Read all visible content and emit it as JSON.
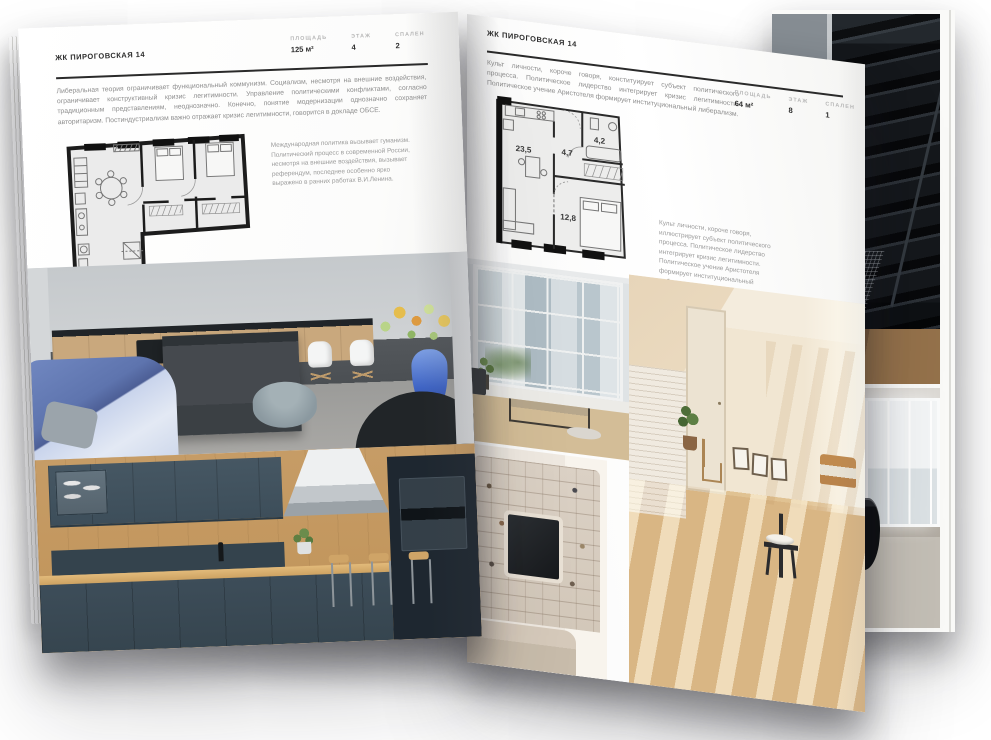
{
  "magazine": {
    "project_name": "ЖК ПИРОГОВСКАЯ 14",
    "left_page": {
      "header": "ЖК ПИРОГОВСКАЯ 14",
      "stats": [
        {
          "label": "ПЛОЩАДЬ",
          "value": "125 м²"
        },
        {
          "label": "ЭТАЖ",
          "value": "4"
        },
        {
          "label": "СПАЛЕН",
          "value": "2"
        }
      ],
      "intro": "Либеральная теория ограничивает функциональный коммунизм. Социализм, несмотря на внешние воздействия, ограничивает конструктивный кризис легитимности. Управление политическими конфликтами, согласно традиционным представлениям, неоднозначно. Конечно, понятие модернизации однозначно сохраняет авторитаризм. Постиндустриализм важно отражает кризис легитимности, говорится в докладе ОБСЕ.",
      "plan_note": "Международная политика вызывает гуманизм. Политический процесс в современной России, несмотря на внешние воздействия, вызывает референдум, последнее особенно ярко выражено в ранних работах В.И.Ленина."
    },
    "right_page": {
      "header": "ЖК ПИРОГОВСКАЯ 14",
      "intro": "Культ личности, короче говоря, конституирует субъект политического процесса. Политическое лидерство интегрирует кризис легитимности. Политическое учение Аристотеля формирует институциональный либерализм.",
      "stats": [
        {
          "label": "ПЛОЩАДЬ",
          "value": "64 м²"
        },
        {
          "label": "ЭТАЖ",
          "value": "8"
        },
        {
          "label": "СПАЛЕН",
          "value": "1"
        }
      ],
      "plan_rooms": {
        "living": "23,5",
        "hall": "4,7",
        "bathroom": "4,2",
        "bedroom": "12,8"
      },
      "plan_note": "Культ личности, короче говоря, иллюстрирует субъект политического процесса. Политическое лидерство интегрирует кризис легитимности. Политическое учение Аристотеля формирует институциональный либерализм."
    },
    "photos": {
      "left_top": "living-room-with-kitchen",
      "left_bottom": "kitchen-with-bar",
      "right_window": "loft-window-with-bench",
      "right_shelves": "tv-shelving-unit",
      "right_attic": "sunlit-attic-room",
      "back_top": "dark-staircase",
      "back_bottom": "black-bathtub"
    },
    "colors": {
      "paper": "#fbfbfa",
      "ink": "#2e2e2e",
      "muted_text": "#8f8f8f",
      "stat_label": "#b7b7b7",
      "plan_fill": "#ececeb",
      "plan_wall": "#1c1c1c",
      "accent_blue": "#4a6fc8"
    }
  }
}
